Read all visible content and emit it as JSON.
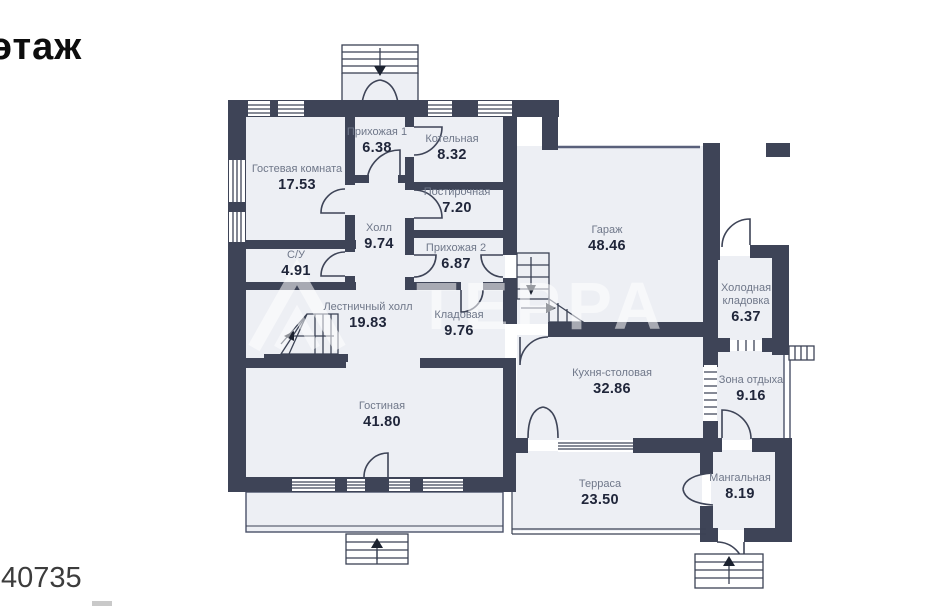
{
  "page": {
    "floor_label": "этаж",
    "listing_number": "40735",
    "watermark": "ТЕРРА"
  },
  "colors": {
    "wall": "#3e4457",
    "room_fill": "#edeff4",
    "thin_line": "#4a5168",
    "room_name": "#6f7789",
    "room_area": "#20263a"
  },
  "rooms": [
    {
      "name": "Гостевая комната",
      "area": "17.53",
      "x": 297,
      "y": 163,
      "w": 95
    },
    {
      "name": "Прихожая 1",
      "area": "6.38",
      "x": 377,
      "y": 126,
      "w": 95
    },
    {
      "name": "Котельная",
      "area": "8.32",
      "x": 452,
      "y": 133,
      "w": 100
    },
    {
      "name": "Постирочная",
      "area": "7.20",
      "x": 457,
      "y": 186,
      "w": 110
    },
    {
      "name": "Холл",
      "area": "9.74",
      "x": 379,
      "y": 222,
      "w": 70
    },
    {
      "name": "С/У",
      "area": "4.91",
      "x": 296,
      "y": 249,
      "w": 70
    },
    {
      "name": "Прихожая 2",
      "area": "6.87",
      "x": 456,
      "y": 242,
      "w": 100
    },
    {
      "name": "Гараж",
      "area": "48.46",
      "x": 607,
      "y": 224,
      "w": 90
    },
    {
      "name": "Холодная кладовка",
      "area": "6.37",
      "x": 746,
      "y": 282,
      "w": 76
    },
    {
      "name": "Лестничный холл",
      "area": "19.83",
      "x": 368,
      "y": 301,
      "w": 92
    },
    {
      "name": "Кладовая",
      "area": "9.76",
      "x": 459,
      "y": 309,
      "w": 90
    },
    {
      "name": "Кухня-столовая",
      "area": "32.86",
      "x": 612,
      "y": 367,
      "w": 120
    },
    {
      "name": "Зона отдыха",
      "area": "9.16",
      "x": 751,
      "y": 374,
      "w": 90
    },
    {
      "name": "Гостиная",
      "area": "41.80",
      "x": 382,
      "y": 400,
      "w": 90
    },
    {
      "name": "Терраса",
      "area": "23.50",
      "x": 600,
      "y": 478,
      "w": 90
    },
    {
      "name": "Мангальная",
      "area": "8.19",
      "x": 740,
      "y": 472,
      "w": 100
    }
  ]
}
